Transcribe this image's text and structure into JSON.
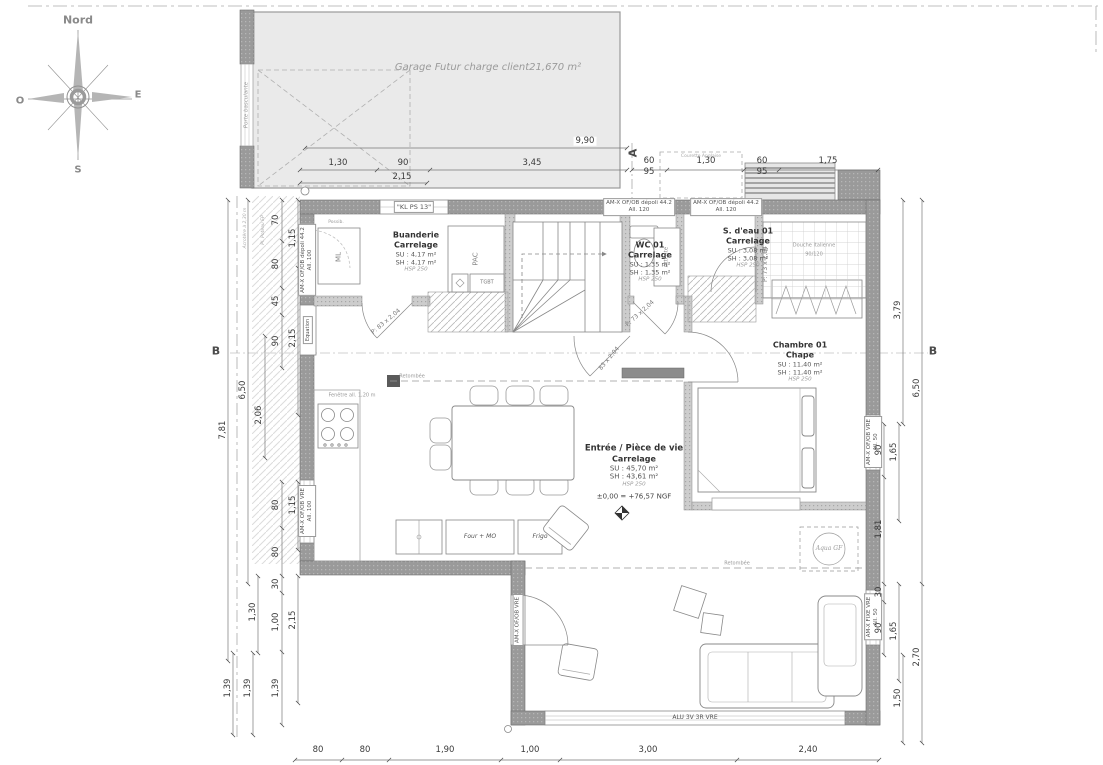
{
  "compass": {
    "north": "Nord",
    "south": "S",
    "east": "E",
    "west": "O"
  },
  "garage": {
    "label": "Garage Futur charge client21,670 m²",
    "door_label": "Porte basculante"
  },
  "rooms": {
    "buanderie": {
      "name": "Buanderie",
      "finish": "Carrelage",
      "su": "SU : 4,17 m²",
      "sh": "SH : 4,17 m²",
      "hsp": "HSP 250"
    },
    "wc": {
      "name": "WC 01",
      "finish": "Carrelage",
      "su": "SU : 1,35 m²",
      "sh": "SH : 1,35 m²",
      "hsp": "HSP 250"
    },
    "salle_eau": {
      "name": "S. d'eau 01",
      "finish": "Carrelage",
      "su": "SU : 3,08 m²",
      "sh": "SH : 3,08 m²",
      "hsp": "HSP 250"
    },
    "chambre": {
      "name": "Chambre 01",
      "finish": "Chape",
      "su": "SU : 11,40 m²",
      "sh": "SH : 11,40 m²",
      "hsp": "HSP 250"
    },
    "sejour": {
      "name": "Entrée / Pièce de vie",
      "finish": "Carrelage",
      "su": "SU : 45,70 m²",
      "sh": "SH : 43,61 m²",
      "hsp": "HSP 250",
      "level": "±0,00 = +76,57 NGF"
    }
  },
  "equipment": {
    "ml": "ML",
    "pac": "PAC",
    "tgbt": "TGBT",
    "attente": "Attente",
    "possib": "Possib.",
    "four": "Four + MO",
    "frigo": "Frigo",
    "douche_line1": "Douche Italienne",
    "douche_line2": "90/120",
    "stamp": "Aqua GF"
  },
  "windows": {
    "depoli": "AM-X OF/OB dépoli 44.2",
    "vre": "AM-X OF/OB VRE",
    "fixe": "AM-X FIXE VRE",
    "alu": "ALU 3V 3R VRE",
    "kl": "\"KL PS 13\"",
    "all_120": "All. 120",
    "all_100": "All. 100",
    "all_50": "All. 50"
  },
  "doors": {
    "p83": "P: 83 x 2,04",
    "p73": "P: 73 x 2,04",
    "s83": "83 x 2,04"
  },
  "annotations": {
    "retombee": "Retombée",
    "fenetre": "Fenêtre all. 1,20 m",
    "equation": "Equation",
    "courette": "Courette Anglaise",
    "acrotere": "Acrotère à 2,30 m",
    "poteau": "Pl. Poteau EP",
    "section_a": "A",
    "section_b": "B"
  },
  "dims": {
    "top": [
      "9,90",
      "1,30",
      "90",
      "3,45",
      "2,15"
    ],
    "topright": [
      "60",
      "95",
      "1,30",
      "60",
      "95",
      "1,75"
    ],
    "left": [
      "70",
      "80",
      "1,15",
      "45",
      "90",
      "2,15",
      "2,06",
      "6,50",
      "7,81"
    ],
    "leftlow": [
      "80",
      "1,15",
      "80",
      "30",
      "1,00",
      "2,15",
      "1,30",
      "1,39",
      "1,39",
      "1,39"
    ],
    "right": [
      "3,79",
      "6,50",
      "90",
      "1,65",
      "1,81",
      "30",
      "90",
      "1,65",
      "2,70",
      "1,50"
    ],
    "bottom": [
      "80",
      "80",
      "1,90",
      "1,00",
      "3,00",
      "2,40"
    ]
  }
}
